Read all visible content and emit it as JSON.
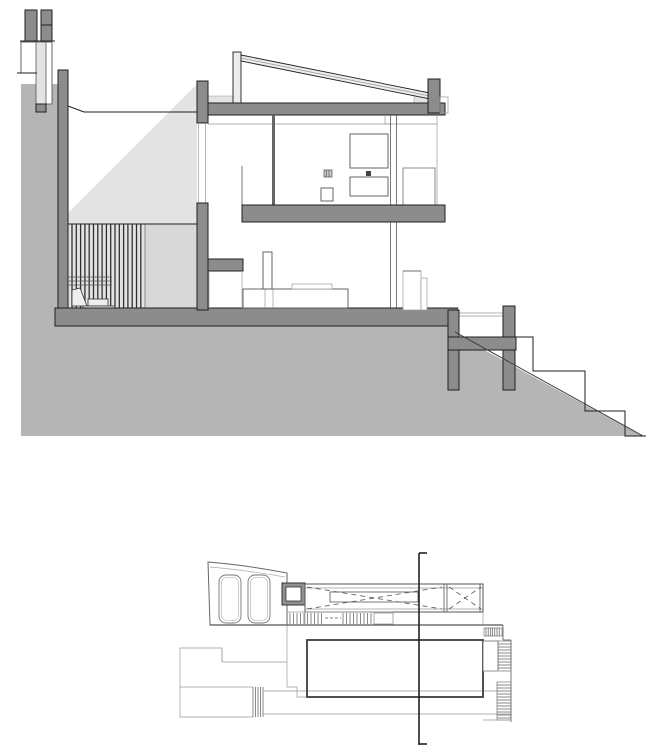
{
  "document": {
    "kind": "architectural-drawing",
    "views": [
      {
        "id": "building-section",
        "label": "building-section"
      },
      {
        "id": "floor-plan",
        "label": "floor-plan-with-section-cut"
      }
    ]
  },
  "section": {
    "slat_count": 17,
    "storeys": 2,
    "site_step_count": 3
  },
  "plan": {
    "car_count": 2,
    "stair_runs": 5,
    "cut_line_ticks": 2
  },
  "colors": {
    "terrain": "#b5b5b5",
    "poche": "#8c8c8c",
    "outline": "#1f1f1f",
    "light": "#e3e3e3",
    "lighter": "#ececec",
    "panel": "#d8d8d8",
    "thin": "#555555",
    "faint": "#999999",
    "cutline": "#222222",
    "paper": "#ffffff"
  }
}
